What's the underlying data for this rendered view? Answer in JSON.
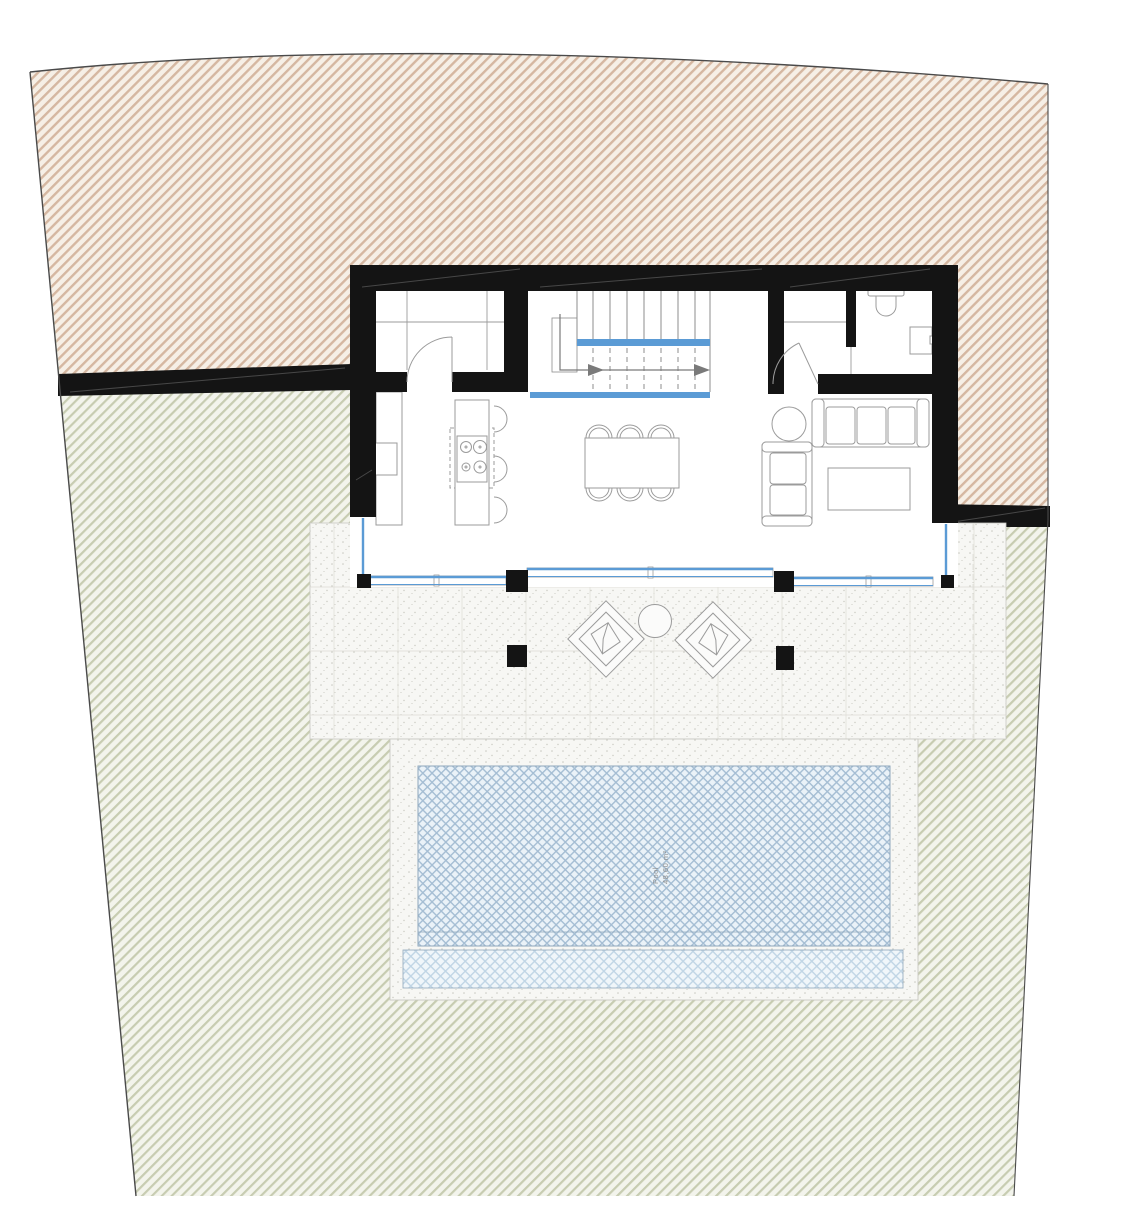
{
  "drawing": {
    "pool_label": {
      "line1": "Pool",
      "line2": "48,60 m²"
    }
  },
  "palette": {
    "terrain_upper_base": "#f6efe6",
    "terrain_upper_hatch": "#d5b7a1",
    "terrain_lower_base": "#f3f4ec",
    "terrain_lower_hatch": "#c7ccb1",
    "boundary": "#4a4a4a",
    "wall": "#141414",
    "wall_accent": "rgba(255,255,255,0.22)",
    "glass": "#5b9bd5",
    "terrace_base": "#f7f7f4",
    "terrace_dot": "#c9c9c1",
    "terrace_grid": "#dddcd5",
    "terrace_outline": "#c9c9c3",
    "pool_base": "#eaf2f8",
    "pool_hatch": "#a4bdd3",
    "pool_edge": "#8fa7bb",
    "shelf_base": "#f0f6fa",
    "shelf_hatch": "#c0d5e5",
    "furniture": "#9b9b9b",
    "stair_tread": "#8d8d8d",
    "walkline": "#7a7a7a",
    "label": "#8f8f8f"
  }
}
